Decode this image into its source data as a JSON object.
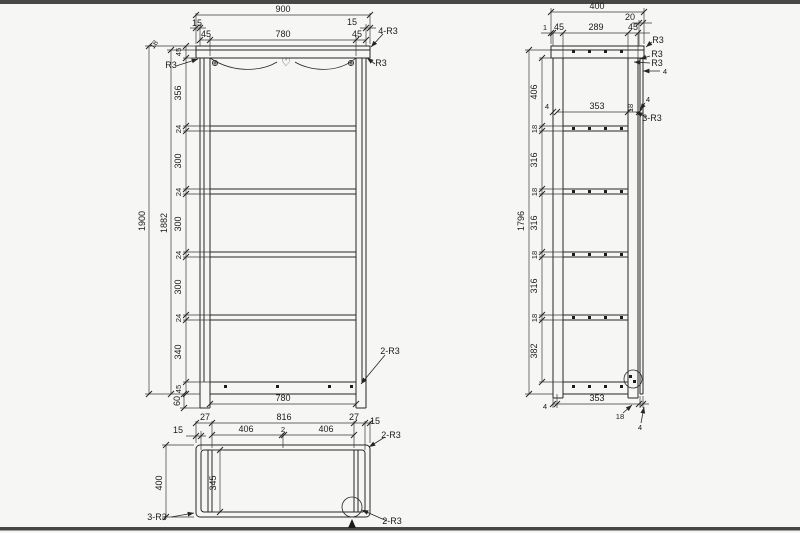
{
  "drawing": {
    "background": "#f6f6f4",
    "line_color": "#262626",
    "front_view": {
      "overall_width": "900",
      "overhang_left": "15",
      "post_left": "45",
      "inner_width": "780",
      "post_right": "45",
      "overhang_right": "15",
      "corner_note": "4-R3",
      "top_thickness": "18",
      "rail_height": "45",
      "radius_left": "R3",
      "radius_right": "R3",
      "overall_height": "1900",
      "inner_height": "1882",
      "segments": [
        "356",
        "24",
        "300",
        "24",
        "300",
        "24",
        "300",
        "24",
        "340",
        "45"
      ],
      "foot_height": "60",
      "bottom_inner_width": "780",
      "bottom_note": "2-R3",
      "heart": "♡"
    },
    "side_view": {
      "overall_depth": "400",
      "top_overhang": "20",
      "back_gap": "1",
      "front_post": "45",
      "top_inner_depth": "289",
      "back_post": "45",
      "radius_top": "R3",
      "radius_a": "R3",
      "radius_b": "R3",
      "panel_thickness": "4",
      "overall_height": "1796",
      "segments": [
        "406",
        "18",
        "316",
        "18",
        "316",
        "18",
        "316",
        "18",
        "382"
      ],
      "shelf_gap_front": "4",
      "shelf_depth": "353",
      "shelf_thickness": "18",
      "shelf_gap_back": "4",
      "shelf_note": "3-R3",
      "bottom_gap_front": "4",
      "bottom_depth": "353",
      "bottom_back": "18",
      "bottom_gap_back": "4"
    },
    "plan_view": {
      "edge_left": "15",
      "corner_left": "27",
      "inner_width": "816",
      "center_gap": "2",
      "bay_left": "406",
      "bay_right": "406",
      "corner_right": "27",
      "edge_right": "15",
      "note_top": "2-R3",
      "overall_depth": "400",
      "panel_length": "345",
      "note_left": "3-R3",
      "note_bottom": "2-R3"
    }
  }
}
